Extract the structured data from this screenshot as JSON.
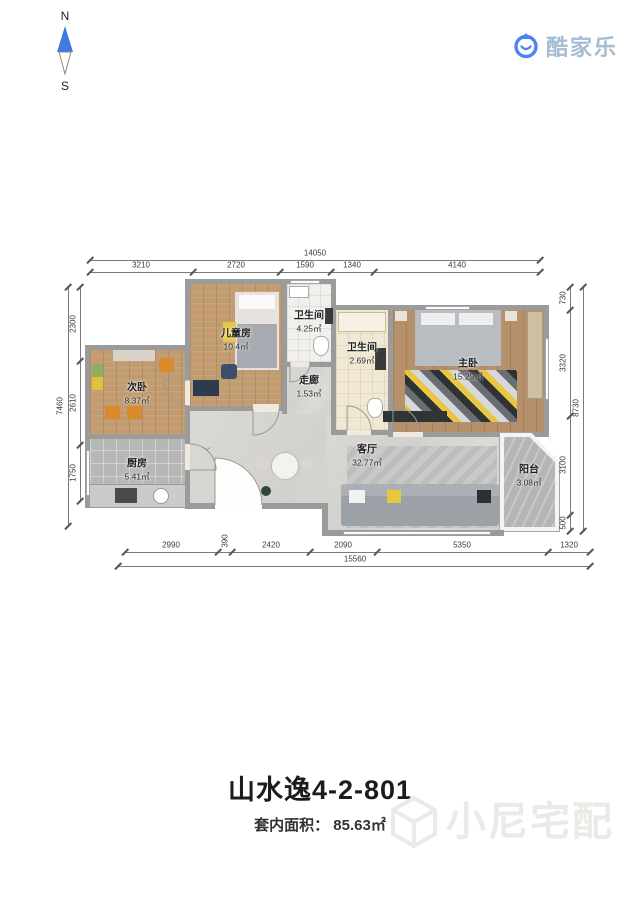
{
  "compass": {
    "north": "N",
    "south": "S"
  },
  "logo": {
    "text": "酷家乐"
  },
  "plan": {
    "entry_marker": "﹀",
    "rooms": [
      {
        "name": "儿童房",
        "area": "10.4㎡"
      },
      {
        "name": "卫生间",
        "area": "4.25㎡"
      },
      {
        "name": "走廊",
        "area": "1.53㎡"
      },
      {
        "name": "卫生间",
        "area": "2.69㎡"
      },
      {
        "name": "主卧",
        "area": "15.29㎡"
      },
      {
        "name": "次卧",
        "area": "8.37㎡"
      },
      {
        "name": "厨房",
        "area": "5.41㎡"
      },
      {
        "name": "客厅",
        "area": "32.77㎡"
      },
      {
        "name": "阳台",
        "area": "3.08㎡"
      }
    ],
    "dimensions": {
      "top": {
        "total": "14050",
        "segments": [
          "3210",
          "2720",
          "1590",
          "1340",
          "4140"
        ]
      },
      "bottom": {
        "total": "15560",
        "segments": [
          "2990",
          "390",
          "2420",
          "2090",
          "5350",
          "1320"
        ]
      },
      "left": {
        "total": "7460",
        "segments": [
          "2300",
          "2610",
          "1750"
        ]
      },
      "right": {
        "total": "8730",
        "segments": [
          "730",
          "3320",
          "3100",
          "500"
        ]
      }
    }
  },
  "footer": {
    "title": "山水逸4-2-801",
    "area_label": "套内面积： 85.63㎡"
  },
  "watermark": {
    "text": "小尼宅配"
  },
  "colors": {
    "wall": "#9b9b9b",
    "wood_floor": "#c29c70",
    "tile_light": "#f1f0ed",
    "tile_gray": "#b7b7b5",
    "living_floor": "#d8d6d2",
    "accent_blue": "#3f7be0",
    "logo_text": "#a6bcd2",
    "accent_yellow": "#e8c63f",
    "accent_orange": "#d98a2b"
  }
}
